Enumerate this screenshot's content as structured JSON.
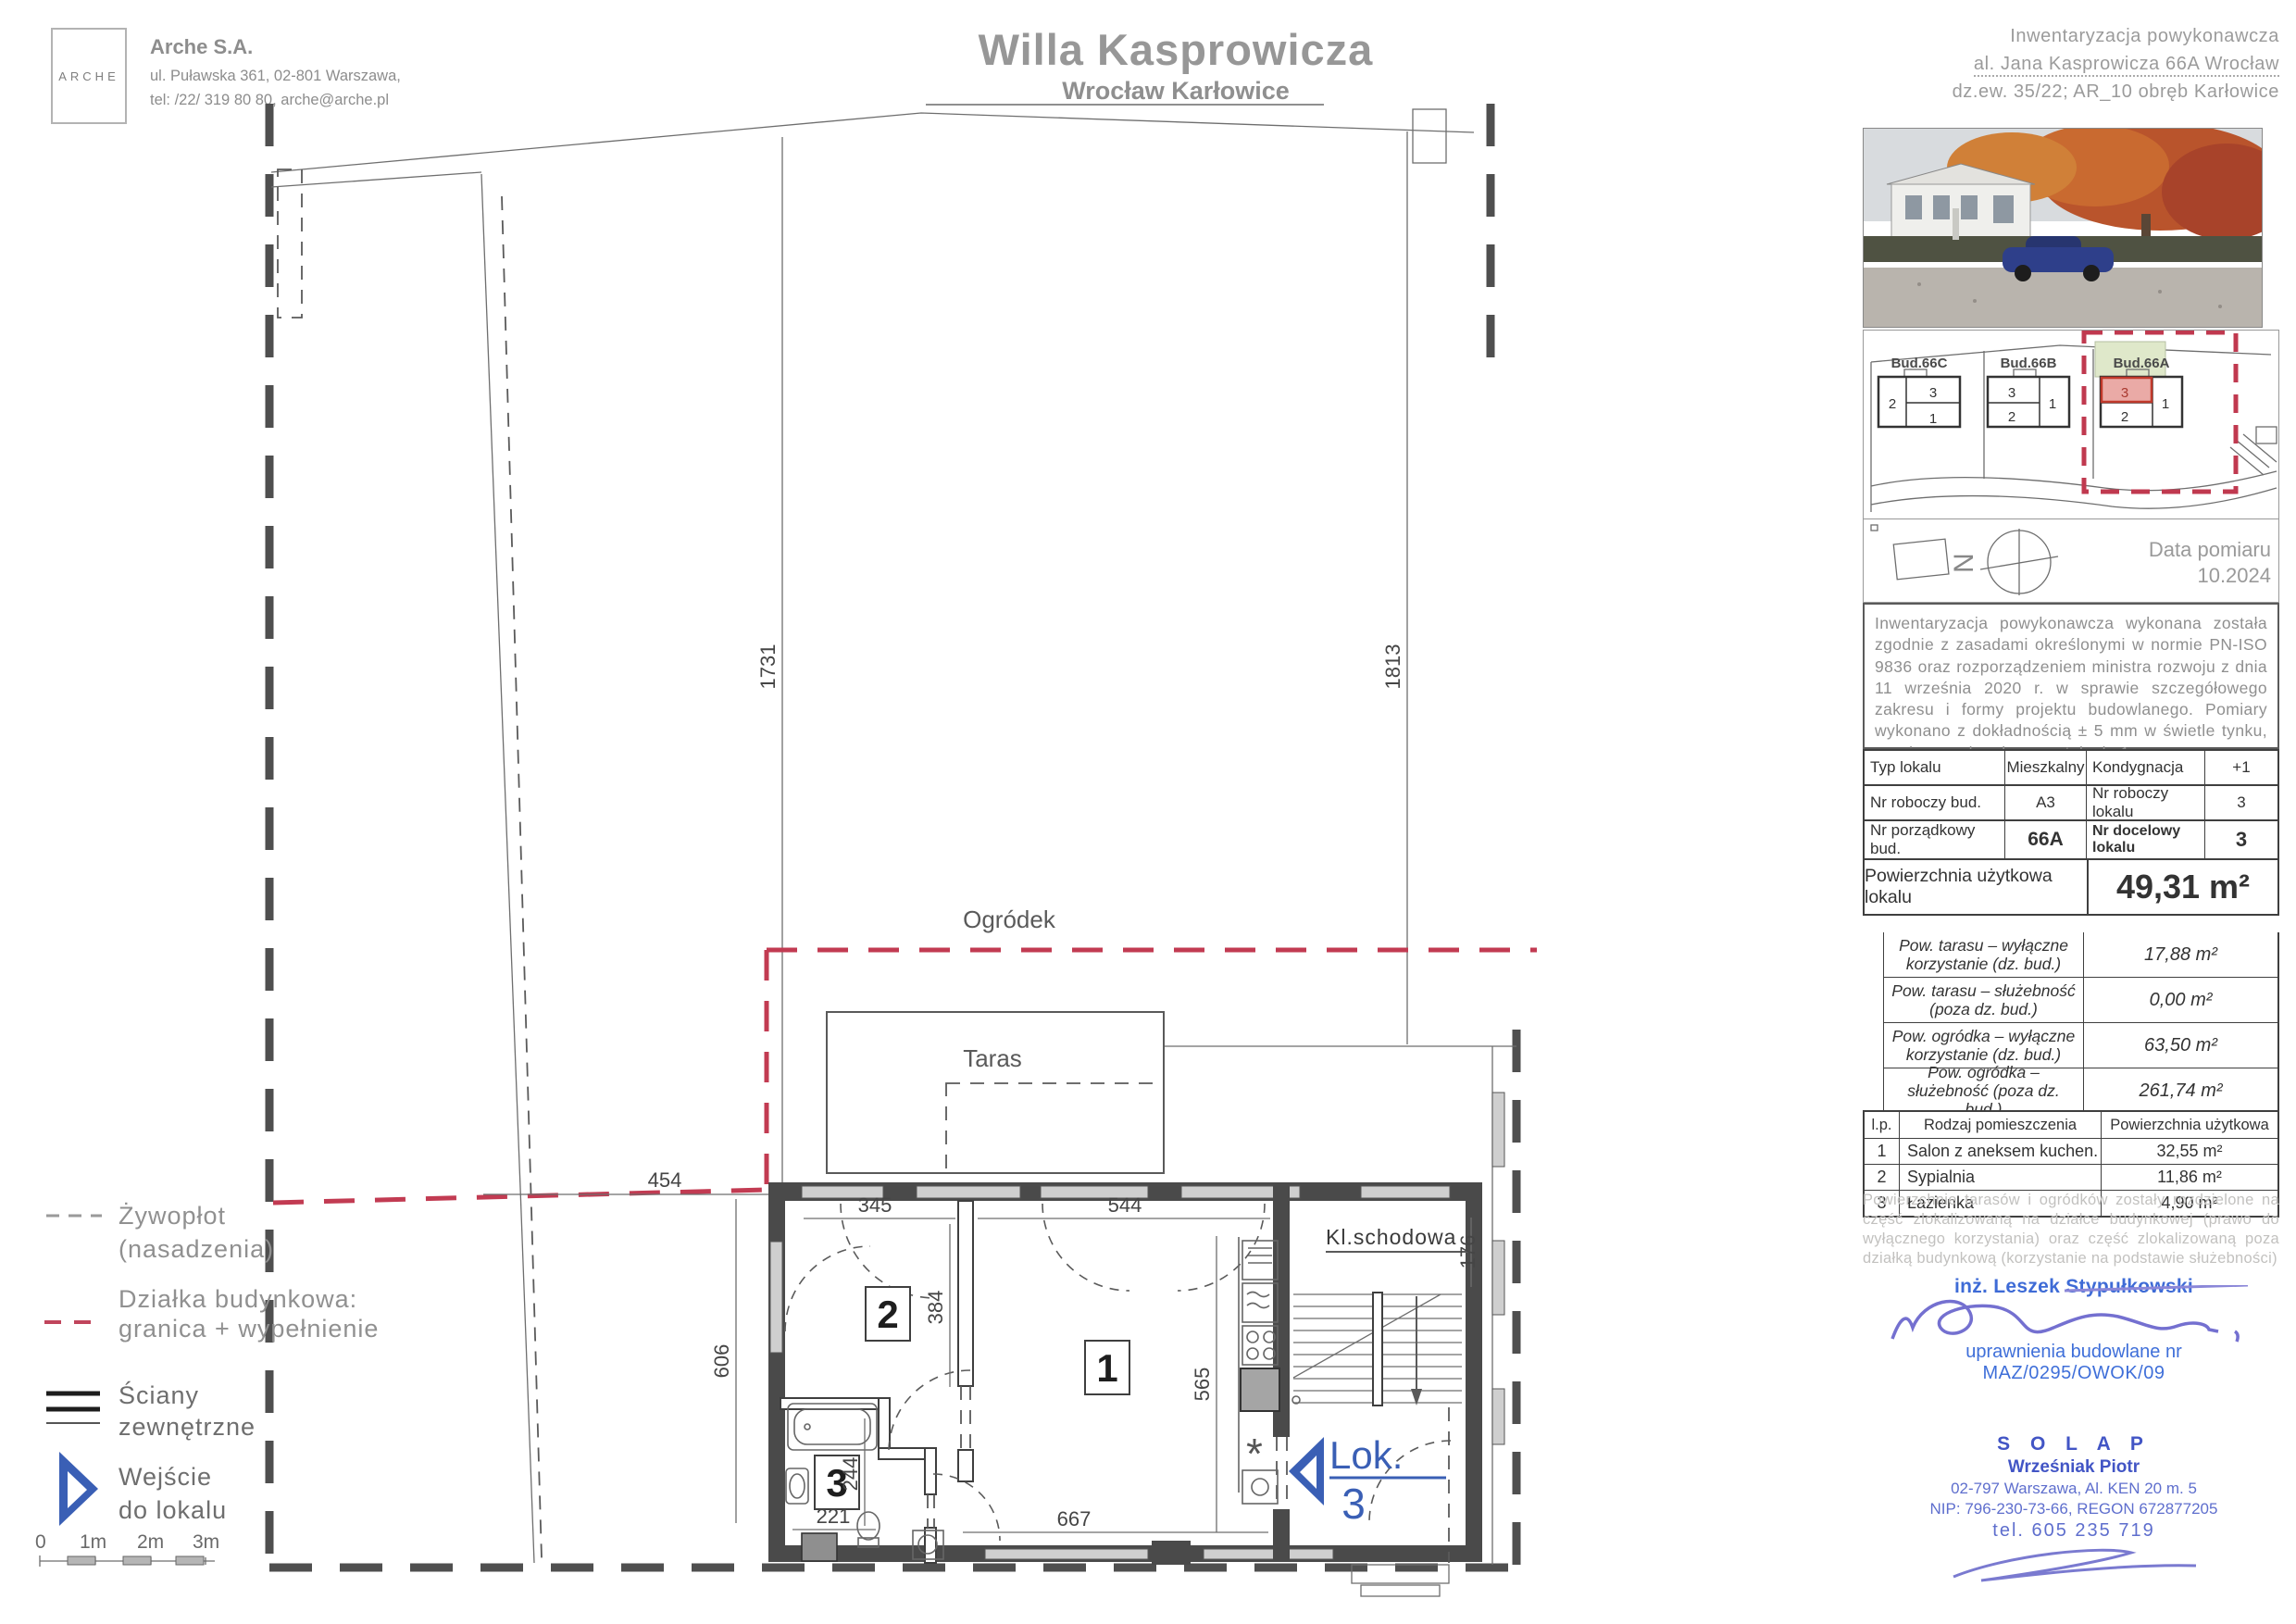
{
  "header": {
    "logo": "ARCHE",
    "company": {
      "name": "Arche S.A.",
      "address": "ul. Puławska 361, 02-801 Warszawa,",
      "phone": "tel: /22/ 319 80 80, arche@arche.pl"
    },
    "title": "Willa Kasprowicza",
    "subtitle": "Wrocław Karłowice",
    "right": {
      "line1": "Inwentaryzacja powykonawcza",
      "line2": "al. Jana Kasprowicza 66A Wrocław",
      "line3": "dz.ew. 35/22; AR_10 obręb Karłowice"
    }
  },
  "plan": {
    "labels": {
      "ogrodek": "Ogródek",
      "taras": "Taras",
      "kl_schodowa": "Kl.schodowa",
      "lok": "Lok.",
      "lok_nr": "3",
      "asterisk": "*"
    },
    "rooms": {
      "r1": "1",
      "r2": "2",
      "r3": "3"
    },
    "dims": {
      "left": "1731",
      "right": "1813",
      "garden": "454",
      "left_h": "606",
      "r2_top": "345",
      "r1_top": "544",
      "mid": "384",
      "kitchen": "565",
      "bath_v": "244",
      "bath_w": "221",
      "bottom": "667",
      "stair": "176"
    }
  },
  "legend": {
    "hedge1": "Żywopłot",
    "hedge2": "(nasadzenia)",
    "parcel1": "Działka budynkowa:",
    "parcel2": "granica + wypełnienie",
    "walls1": "Ściany",
    "walls2": "zewnętrzne",
    "entry1": "Wejście",
    "entry2": "do lokalu",
    "scale": {
      "t0": "0",
      "t1": "1m",
      "t2": "2m",
      "t3": "3m"
    }
  },
  "panel": {
    "site": {
      "b1": "Bud.66C",
      "b2": "Bud.66B",
      "b3": "Bud.66A",
      "b1u": [
        "2",
        "3",
        "1"
      ],
      "b2u": [
        "3",
        "2",
        "1"
      ],
      "b3u": [
        "3",
        "2",
        "1"
      ]
    },
    "compass": {
      "n": "N",
      "date_label": "Data pomiaru",
      "date": "10.2024"
    },
    "note": "Inwentaryzacja powykonawcza wykonana została zgodnie z zasadami określonymi w normie PN-ISO 9836 oraz rozporządzeniem ministra rozwoju z dnia 11 września 2020 r. w sprawie szczegółowego zakresu i formy projektu budowlanego. Pomiary wykonano z dokładnością ± 5 mm w świetle tynku, wymiary zaokrąglone zostały do 1cm.",
    "info": {
      "typ_label": "Typ lokalu",
      "typ_value": "Mieszkalny",
      "kond_label": "Kondygnacja",
      "kond_value": "+1",
      "nrb_label": "Nr roboczy bud.",
      "nrb_value": "A3",
      "nrl_label": "Nr roboczy lokalu",
      "nrl_value": "3",
      "npb_label": "Nr porządkowy bud.",
      "npb_value": "66A",
      "ndl_label": "Nr docelowy lokalu",
      "ndl_value": "3",
      "area_label": "Powierzchnia użytkowa lokalu",
      "area_value": "49,31 m²"
    },
    "areas": [
      {
        "label": "Pow. tarasu – wyłączne korzystanie (dz. bud.)",
        "value": "17,88 m²"
      },
      {
        "label": "Pow. tarasu – służebność (poza dz. bud.)",
        "value": "0,00 m²"
      },
      {
        "label": "Pow. ogródka – wyłączne korzystanie (dz. bud.)",
        "value": "63,50 m²"
      },
      {
        "label": "Pow. ogródka – służebność (poza dz. bud.)",
        "value": "261,74 m²"
      }
    ],
    "room_table": {
      "h1": "l.p.",
      "h2": "Rodzaj pomieszczenia",
      "h3": "Powierzchnia użytkowa",
      "rows": [
        {
          "no": "1",
          "name": "Salon z aneksem kuchen.",
          "area": "32,55 m²"
        },
        {
          "no": "2",
          "name": "Sypialnia",
          "area": "11,86 m²"
        },
        {
          "no": "3",
          "name": "Łazienka",
          "area": "4,90 m²"
        }
      ]
    },
    "footnote": "Powierzchnie tarasów i ogródków zostały rozdzielone na część zlokalizowaną na działce budynkowej (prawo do wyłącznego korzystania) oraz część zlokalizowaną poza działką budynkową (korzystanie na podstawie służebności)",
    "signature": {
      "name": "inż. Leszek Stypułkowski",
      "cert1": "uprawnienia budowlane nr",
      "cert2": "MAZ/0295/OWOK/09"
    },
    "stamp": {
      "name": "S O L A P",
      "person": "Wrześniak Piotr",
      "addr": "02-797 Warszawa, Al. KEN 20 m. 5",
      "nip": "NIP: 796-230-73-66, REGON 672877205",
      "tel": "tel. 605 235 719"
    }
  },
  "colors": {
    "accent_red": "#c23b52",
    "accent_blue": "#3a5fb5",
    "signature_blue": "#3e6bd6",
    "stamp_blue": "#4255c5",
    "site_green": "#dfe8ca",
    "unit_red_fill": "#eaaaa6"
  }
}
